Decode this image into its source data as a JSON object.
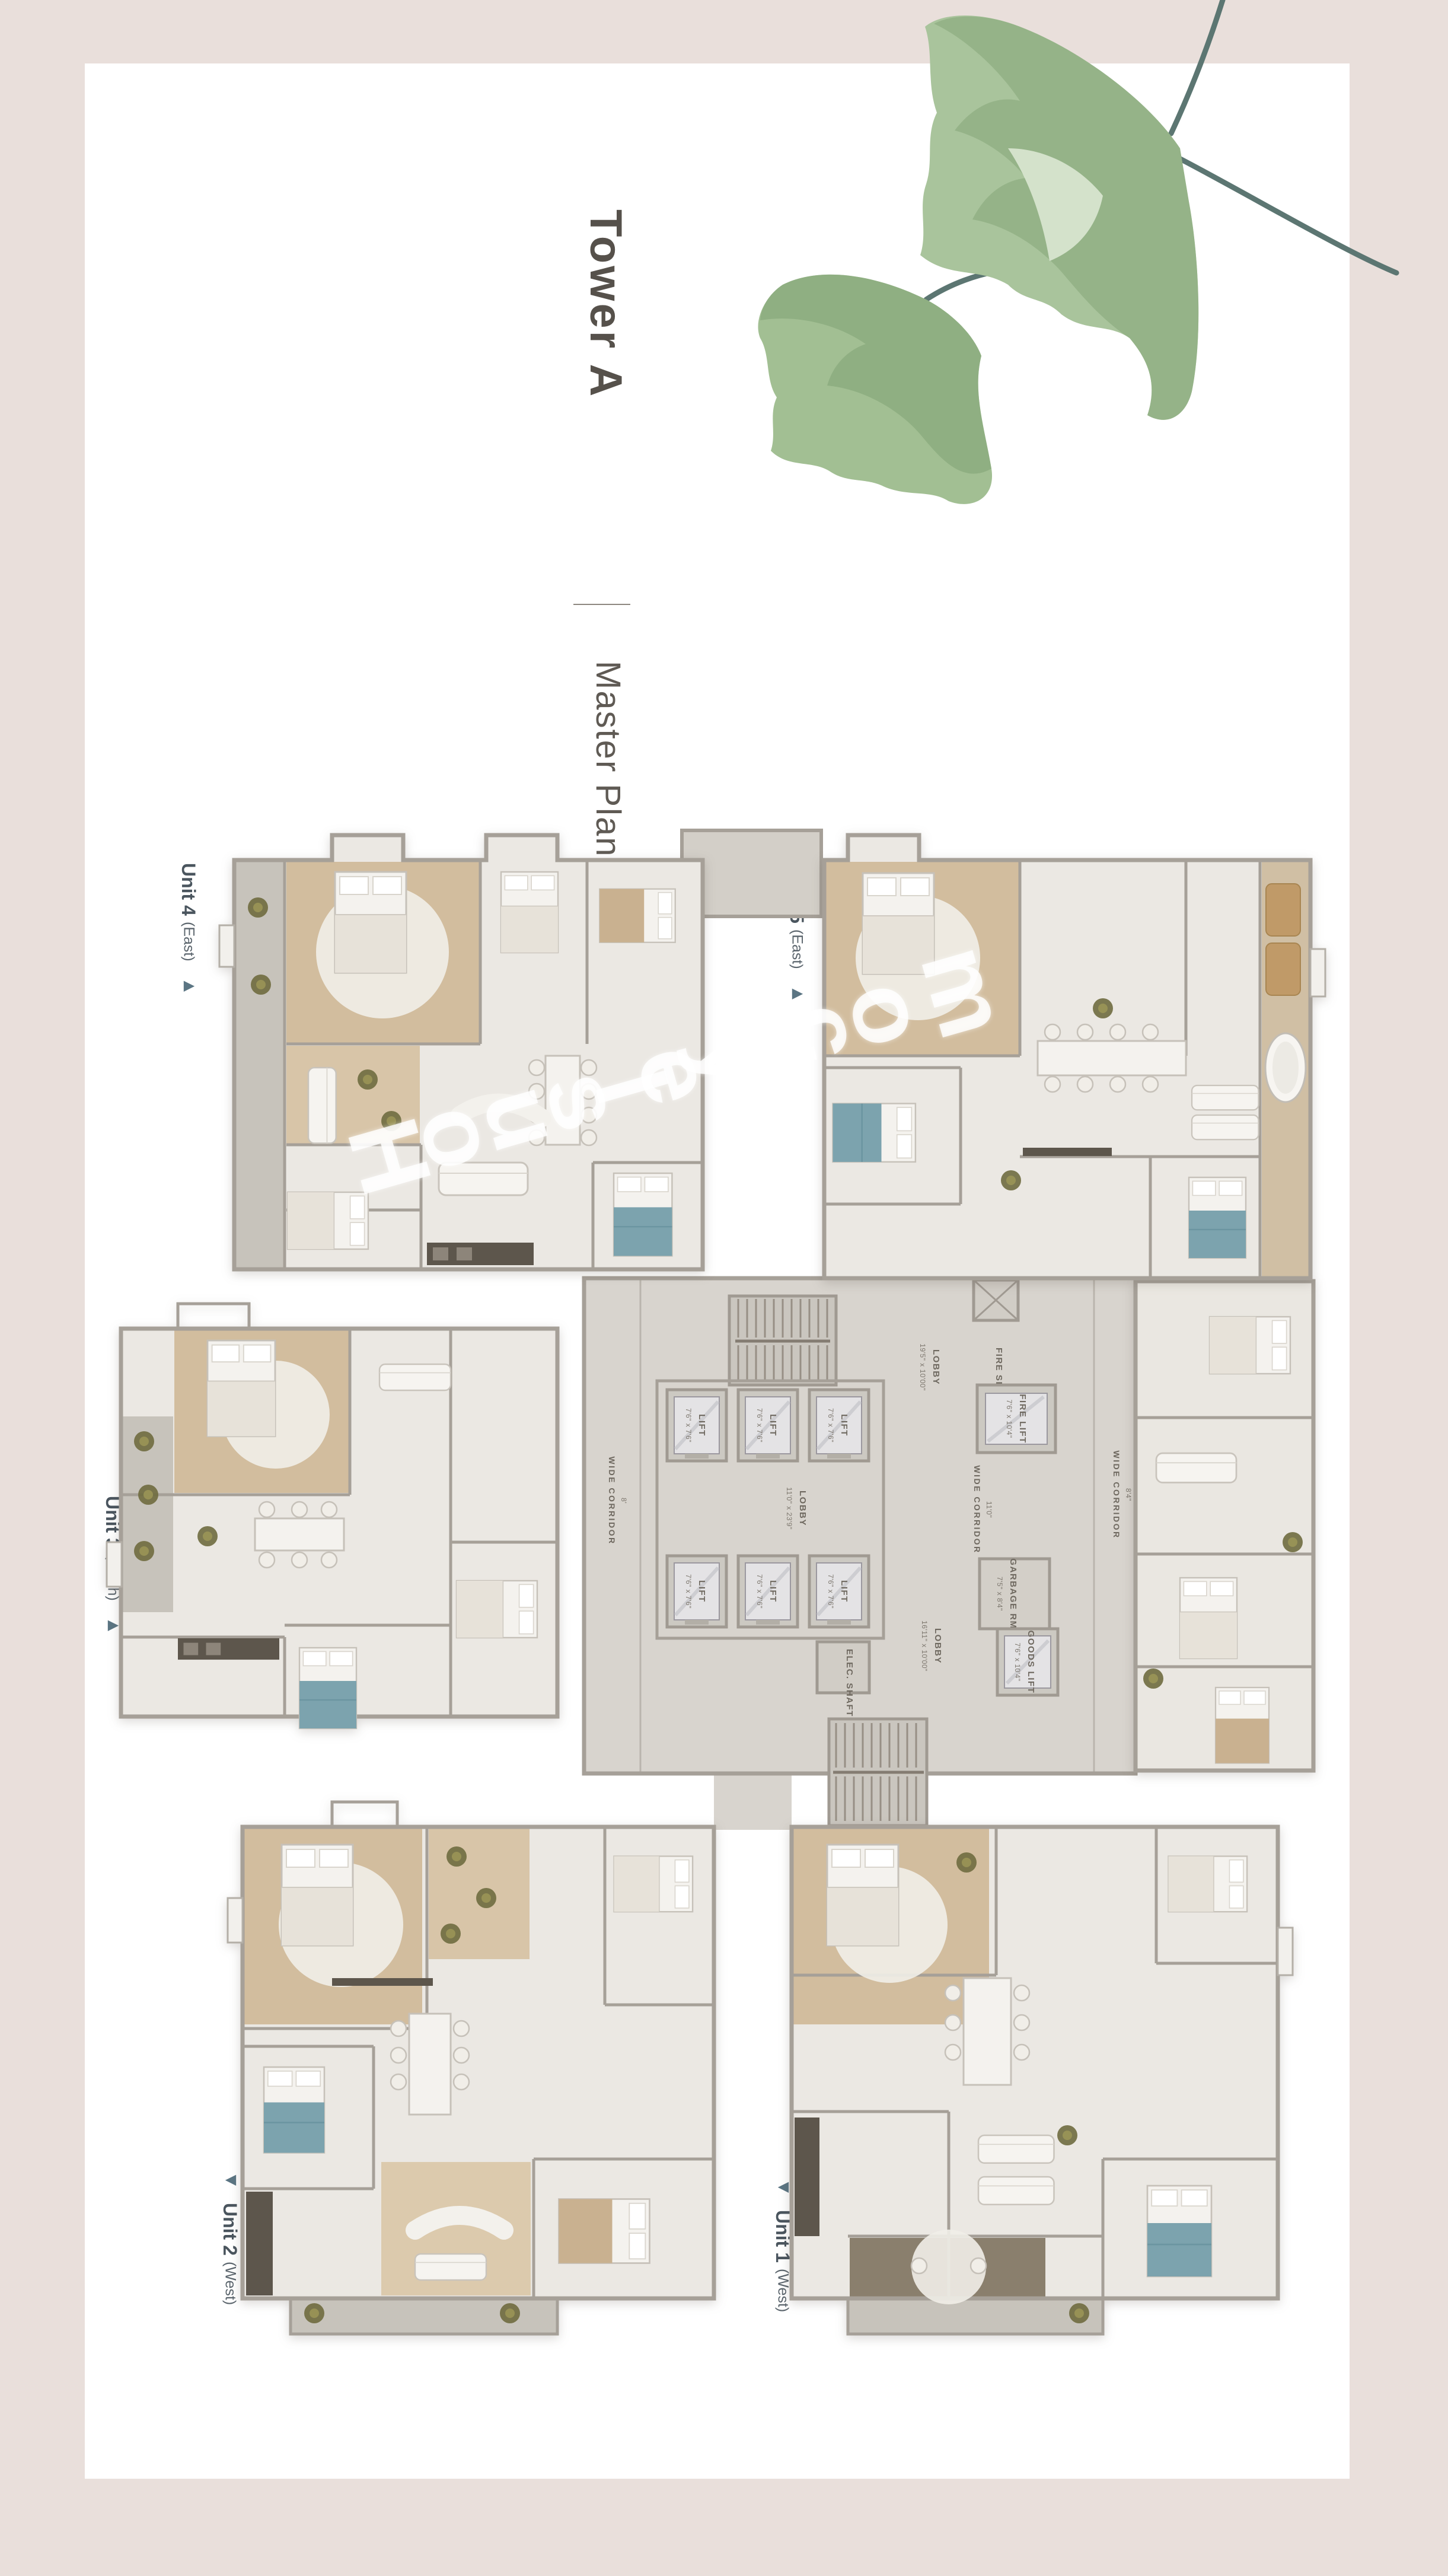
{
  "page": {
    "title": "Tower A",
    "subtitle": "Master Plan",
    "watermark": "Housley.com"
  },
  "units": [
    {
      "name": "Unit 1",
      "direction": "(West)",
      "arrow": "◀"
    },
    {
      "name": "Unit 2",
      "direction": "(West)",
      "arrow": "◀"
    },
    {
      "name": "Unit 3",
      "direction": "(North)",
      "arrow": "▶"
    },
    {
      "name": "Unit 4",
      "direction": "(East)",
      "arrow": "▶"
    },
    {
      "name": "Unit 5",
      "direction": "(East)",
      "arrow": "▶"
    }
  ],
  "core": {
    "lift": {
      "name": "LIFT",
      "dims": "7'6\" x 7'6\""
    },
    "fire_lift": {
      "name": "FIRE LIFT",
      "dims": "7'6\" x 10'4\""
    },
    "goods_lift": {
      "name": "GOODS LIFT",
      "dims": "7'6\" x 10'4\""
    },
    "garbage_rm": {
      "name": "GARBAGE RM",
      "dims": "7'5\" x 8'4\""
    },
    "fire_shaft": "FIRE SHAFT",
    "elec_shaft": "ELEC. SHAFT",
    "lobby_top": {
      "name": "LOBBY",
      "dims": "19'5\" x 10'00\""
    },
    "lobby_mid": {
      "name": "LOBBY",
      "dims": "11'0\" x 23'9\""
    },
    "lobby_bottom": {
      "name": "LOBBY",
      "dims": "16'11\" x 10'00\""
    },
    "corridor_left": {
      "name": "WIDE CORRIDOR",
      "dims": "8'"
    },
    "corridor_mid": {
      "name": "WIDE CORRIDOR",
      "dims": "11'0\""
    },
    "corridor_right": {
      "name": "WIDE CORRIDOR",
      "dims": "8'4\""
    }
  }
}
